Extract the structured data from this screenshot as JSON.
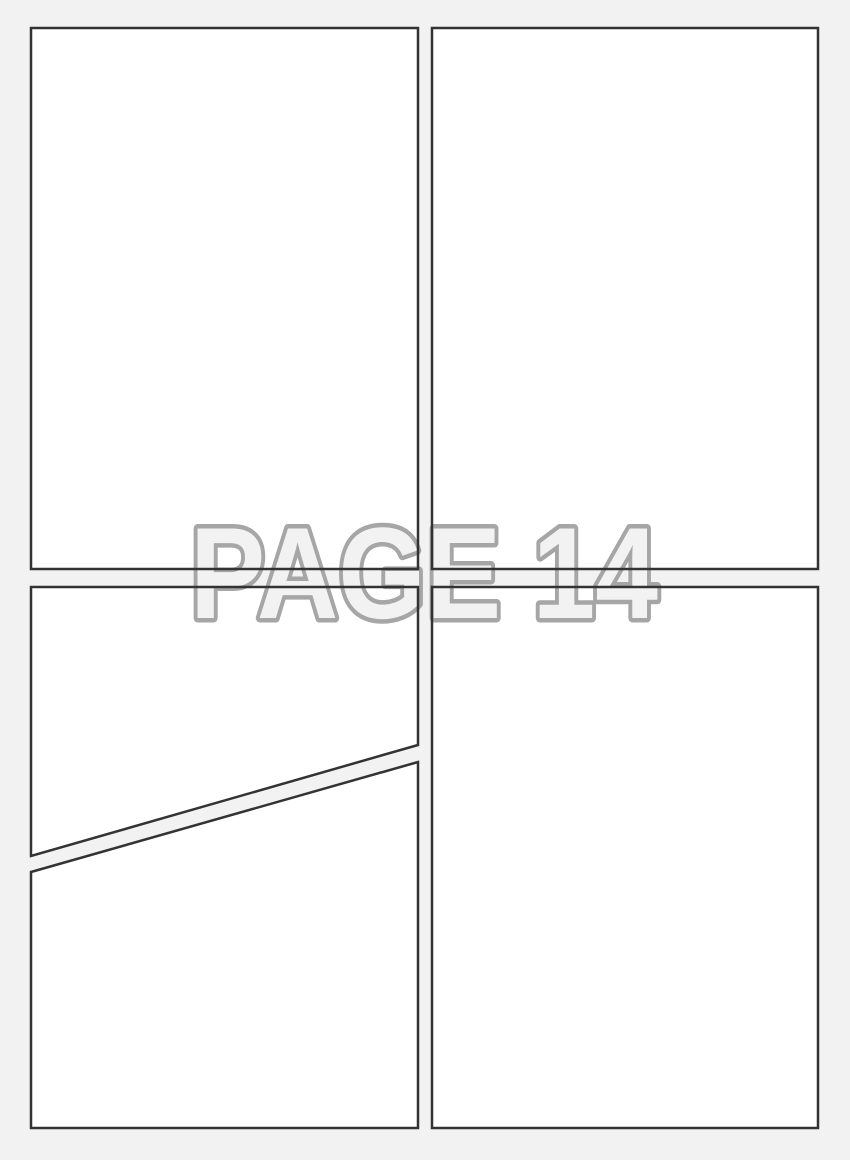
{
  "page": {
    "title": "Comic page template",
    "watermark_label": "PAGE 14",
    "colors": {
      "background": "#f2f2f2",
      "panel_fill": "#ffffff",
      "panel_border": "#333333",
      "watermark_outline": "#a6a6a6",
      "watermark_fill": "#f2f2f2"
    },
    "border_width": 2.5
  },
  "panels": [
    {
      "id": "panel-top-left",
      "points": "31,28 418,28 418,569 31,569"
    },
    {
      "id": "panel-top-right",
      "points": "432,28 818,28 818,569 432,569"
    },
    {
      "id": "panel-middle-left-upper",
      "points": "31,587 418,587 418,745 31,856"
    },
    {
      "id": "panel-bottom-left",
      "points": "31,872 418,762 418,1128 31,1128"
    },
    {
      "id": "panel-bottom-right",
      "points": "432,587 818,587 818,1128 432,1128"
    }
  ],
  "watermark": {
    "x": 424,
    "y": 618,
    "font_size": 130,
    "text_length": 468,
    "stroke_width": 9
  }
}
